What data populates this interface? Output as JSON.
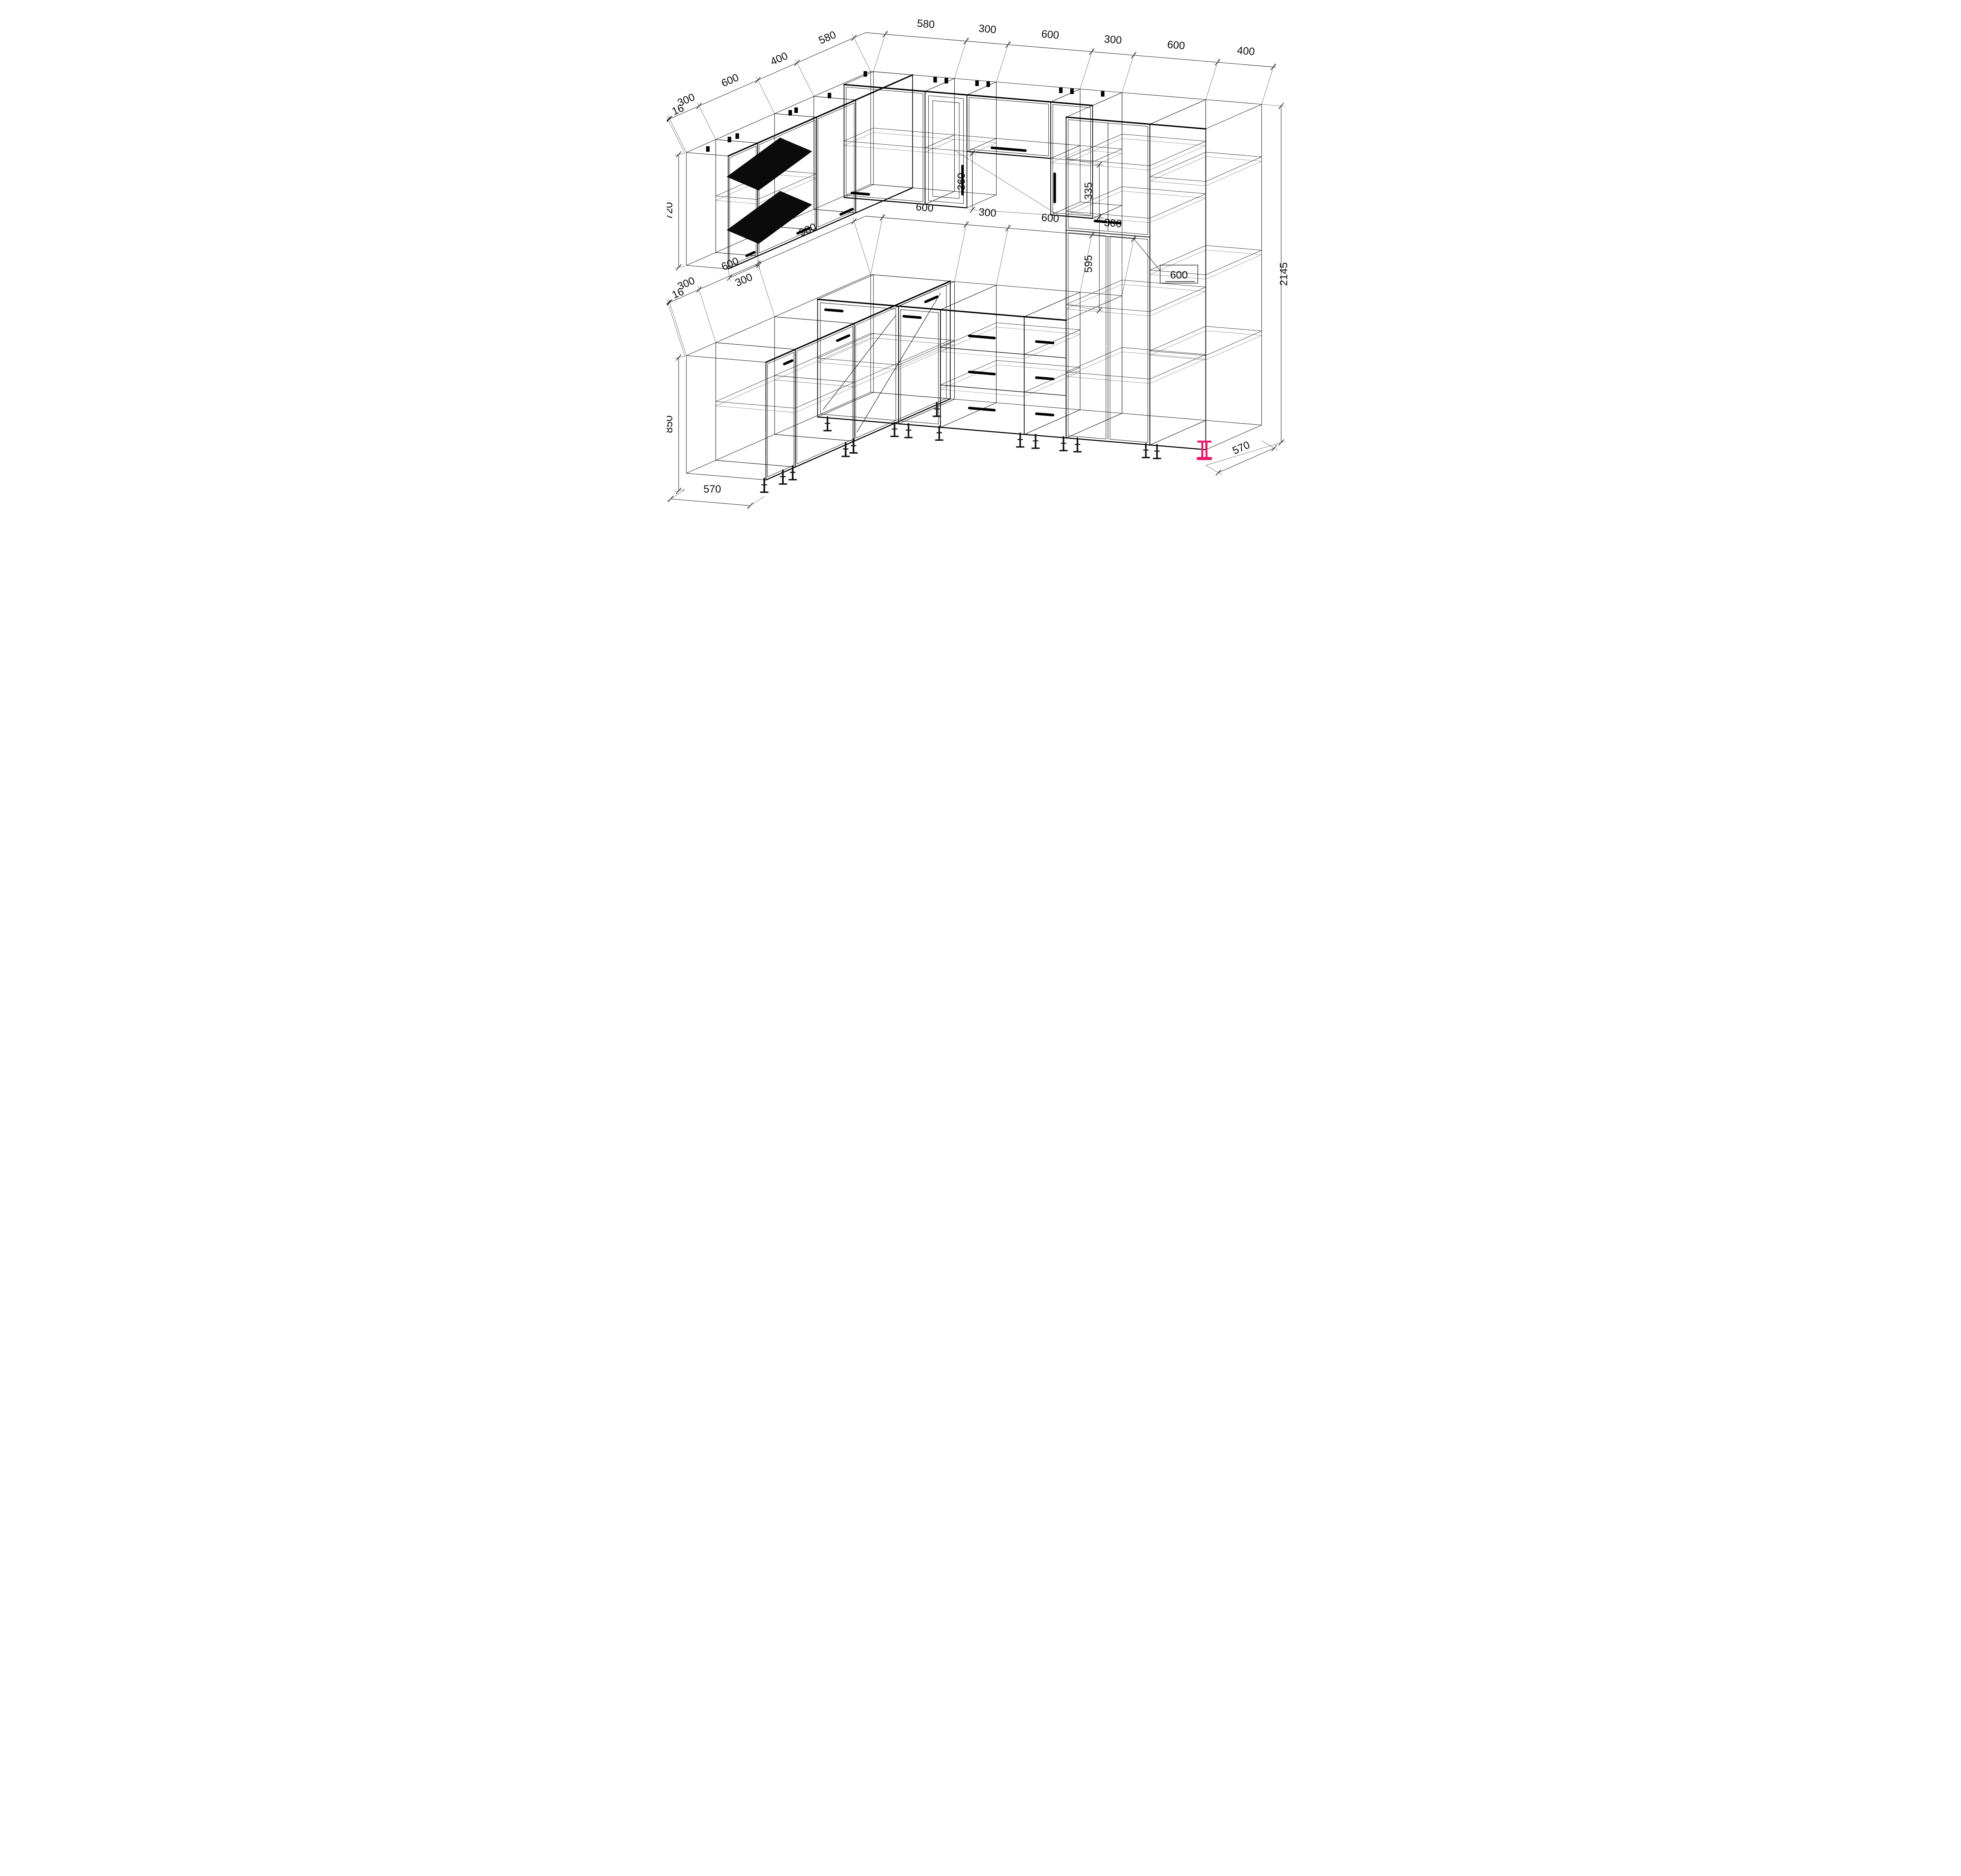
{
  "drawing": {
    "type": "kitchen-furniture-wireframe",
    "units": "mm",
    "colors": {
      "background": "#ffffff",
      "line": "#1c1c1c",
      "accent_foot": "#e8186b"
    },
    "dims": {
      "wall_top_left_chain": [
        "16",
        "300",
        "600",
        "400",
        "580"
      ],
      "wall_top_back_chain": [
        "580",
        "300",
        "600",
        "300",
        "600",
        "400"
      ],
      "base_left_chain": [
        "16",
        "300",
        "600",
        "980"
      ],
      "base_back_chain": [
        "600",
        "300",
        "600",
        "300"
      ],
      "tall_unit_width_callout": "600",
      "wall_cabinet_height": "720",
      "wall_cabinet_bottom_width": "300",
      "hood_gap_height": "360",
      "tall_top_gap": "335",
      "tall_mid_gap": "595",
      "base_height": "850",
      "total_height": "2145",
      "left_depth": "570",
      "right_depth": "570"
    }
  }
}
